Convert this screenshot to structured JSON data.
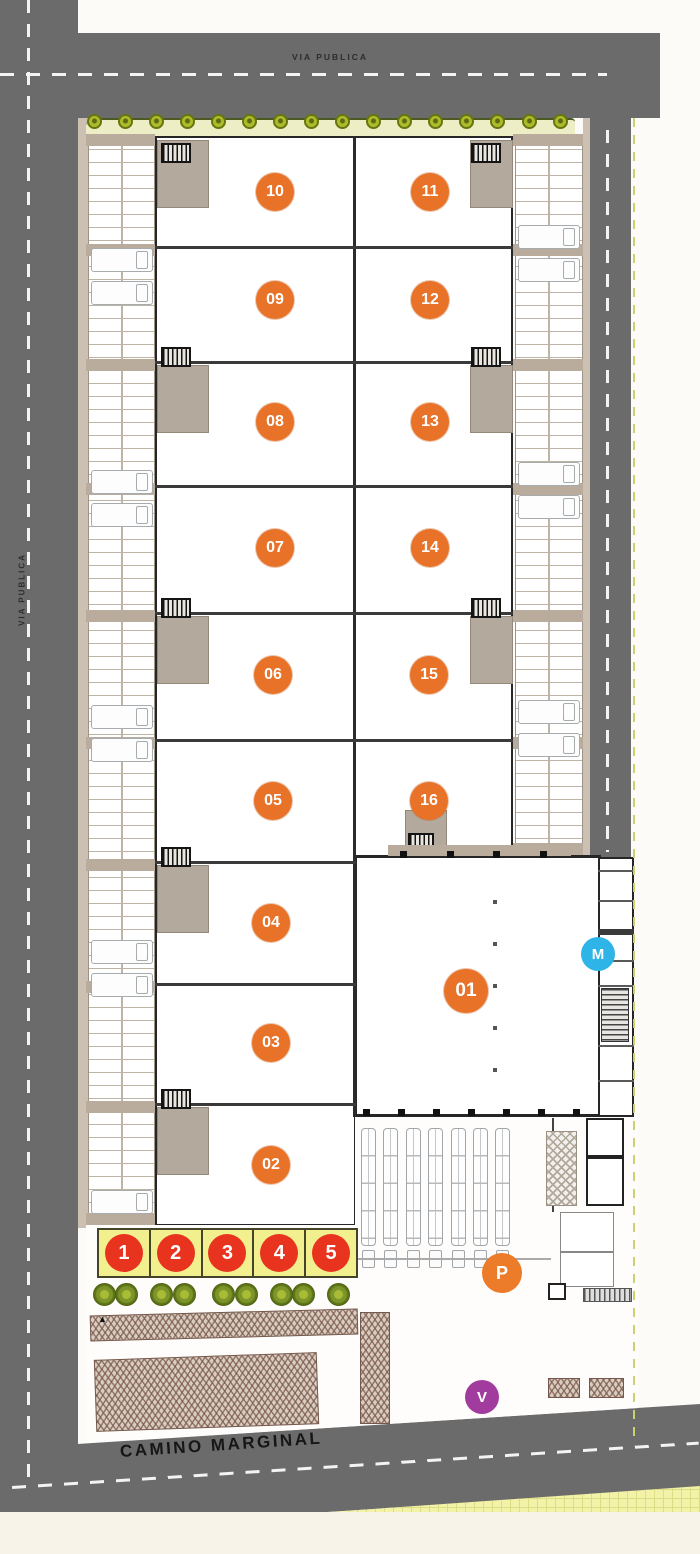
{
  "roads": {
    "color": "#6b6b6b",
    "dash_color": "#f3f3f3",
    "top": {
      "label": "VIA PUBLICA"
    },
    "left": {
      "label": "VIA PUBLICA"
    },
    "bottom": {
      "label": "CAMINO MARGINAL"
    }
  },
  "units": [
    {
      "label": "01",
      "cx": 466,
      "cy": 991,
      "r": 22
    },
    {
      "label": "02",
      "cx": 271,
      "cy": 1165,
      "r": 19
    },
    {
      "label": "03",
      "cx": 271,
      "cy": 1043,
      "r": 19
    },
    {
      "label": "04",
      "cx": 271,
      "cy": 923,
      "r": 19
    },
    {
      "label": "05",
      "cx": 273,
      "cy": 801,
      "r": 19
    },
    {
      "label": "06",
      "cx": 273,
      "cy": 675,
      "r": 19
    },
    {
      "label": "07",
      "cx": 275,
      "cy": 548,
      "r": 19
    },
    {
      "label": "08",
      "cx": 275,
      "cy": 422,
      "r": 19
    },
    {
      "label": "09",
      "cx": 275,
      "cy": 300,
      "r": 19
    },
    {
      "label": "10",
      "cx": 275,
      "cy": 192,
      "r": 19
    },
    {
      "label": "11",
      "cx": 430,
      "cy": 192,
      "r": 19
    },
    {
      "label": "12",
      "cx": 430,
      "cy": 300,
      "r": 19
    },
    {
      "label": "13",
      "cx": 430,
      "cy": 422,
      "r": 19
    },
    {
      "label": "14",
      "cx": 430,
      "cy": 548,
      "r": 19
    },
    {
      "label": "15",
      "cx": 429,
      "cy": 675,
      "r": 19
    },
    {
      "label": "16",
      "cx": 429,
      "cy": 801,
      "r": 19
    }
  ],
  "unit_badge_color": "#e87227",
  "entrance_stalls": {
    "labels": [
      "1",
      "2",
      "3",
      "4",
      "5"
    ],
    "circle_color": "#e8341f",
    "cell_color": "#f2ef8e"
  },
  "markers": [
    {
      "label": "M",
      "color": "#2eb4e6",
      "cx": 598,
      "cy": 954,
      "r": 17
    },
    {
      "label": "P",
      "color": "#ed7c2a",
      "cx": 502,
      "cy": 1273,
      "r": 20
    },
    {
      "label": "V",
      "color": "#a13c9e",
      "cx": 482,
      "cy": 1397,
      "r": 17
    }
  ],
  "annotations": {
    "ramp_arrow": "▲"
  },
  "landscape": {
    "street_trees": 16,
    "entry_bushes": 9
  },
  "loading_bays": 7,
  "parking": {
    "left_truck_stalls": 9,
    "right_truck_stalls": 6
  }
}
